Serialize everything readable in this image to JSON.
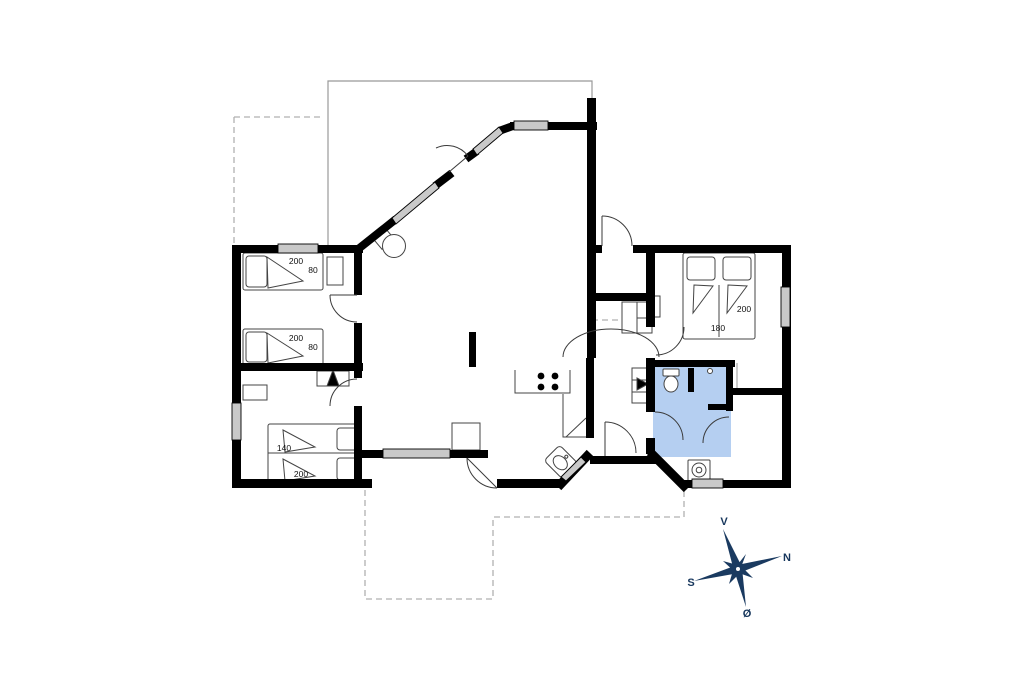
{
  "plan": {
    "bed_labels": {
      "left_top_a_length": "200",
      "left_top_a_width": "80",
      "left_top_b_length": "200",
      "left_top_b_width": "80",
      "left_bottom_width": "140",
      "left_bottom_length": "200",
      "right_length": "200",
      "right_width": "180"
    },
    "compass": {
      "west": "V",
      "north": "N",
      "south": "S",
      "east": "Ø"
    },
    "colors": {
      "wall": "#000000",
      "bathroom_fill": "#b5cff1",
      "window_fill": "#c9c9c9",
      "compass": "#1a3a60",
      "dashed_outline": "#b0b0b0",
      "thin_outline": "#999999"
    }
  }
}
